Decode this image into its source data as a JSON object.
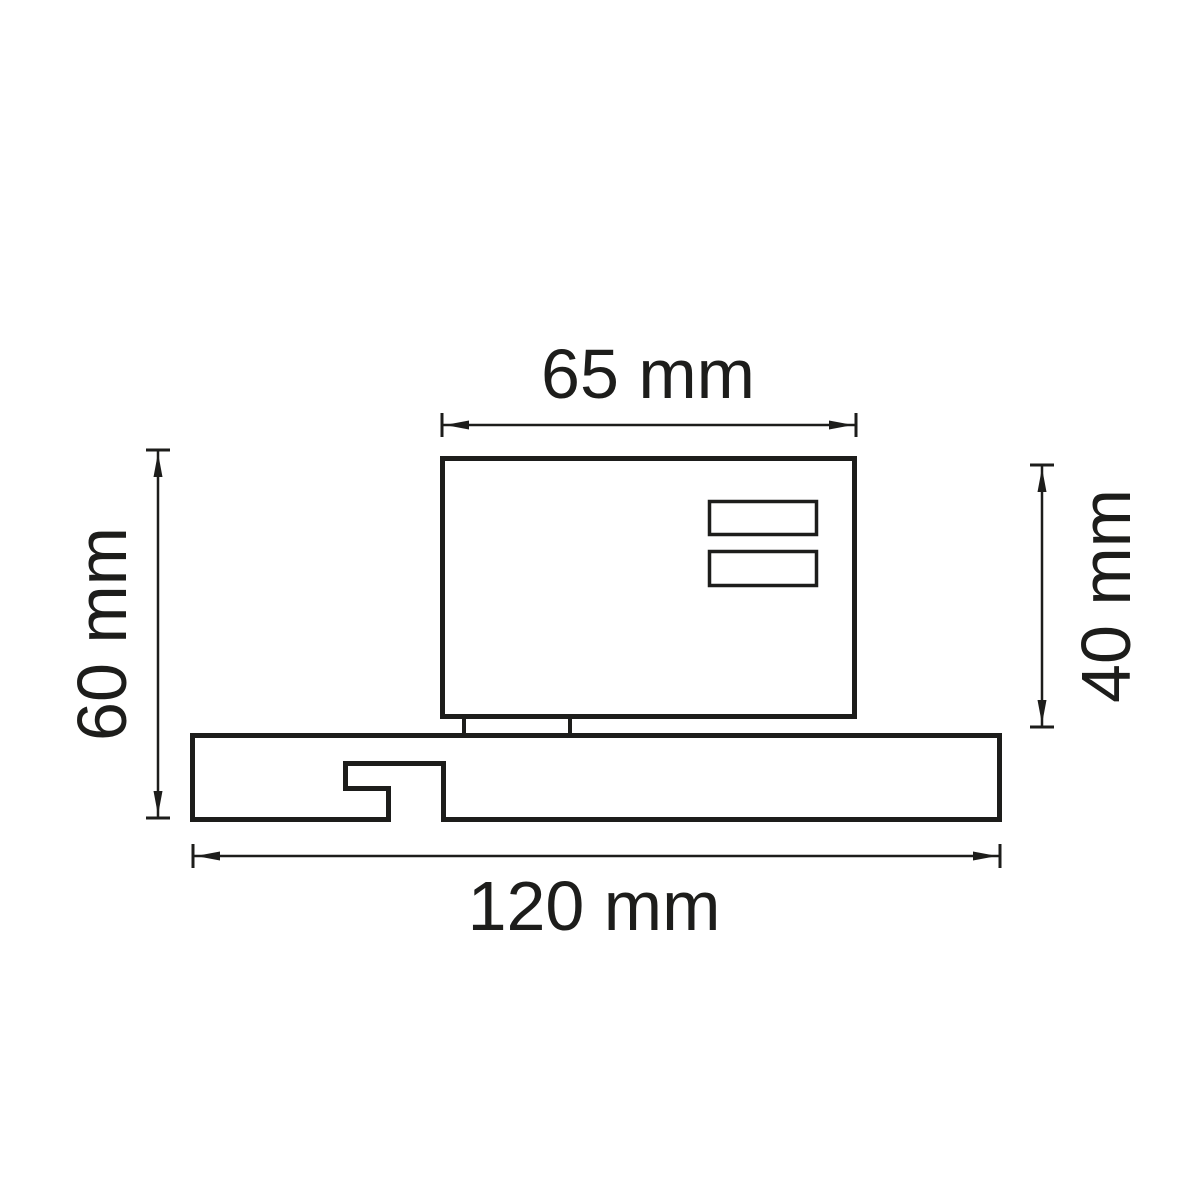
{
  "canvas": {
    "background": "#ffffff",
    "line_color": "#1d1d1b",
    "description": "Technical dimension drawing of a track-mounted fixture side view"
  },
  "dimensions": {
    "top": {
      "label": "65 mm",
      "orientation": "horizontal",
      "measures": "body width"
    },
    "left": {
      "label": "60 mm",
      "orientation": "vertical",
      "measures": "overall height"
    },
    "right": {
      "label": "40 mm",
      "orientation": "vertical",
      "measures": "body height"
    },
    "bottom": {
      "label": "120 mm",
      "orientation": "horizontal",
      "measures": "base length"
    }
  }
}
